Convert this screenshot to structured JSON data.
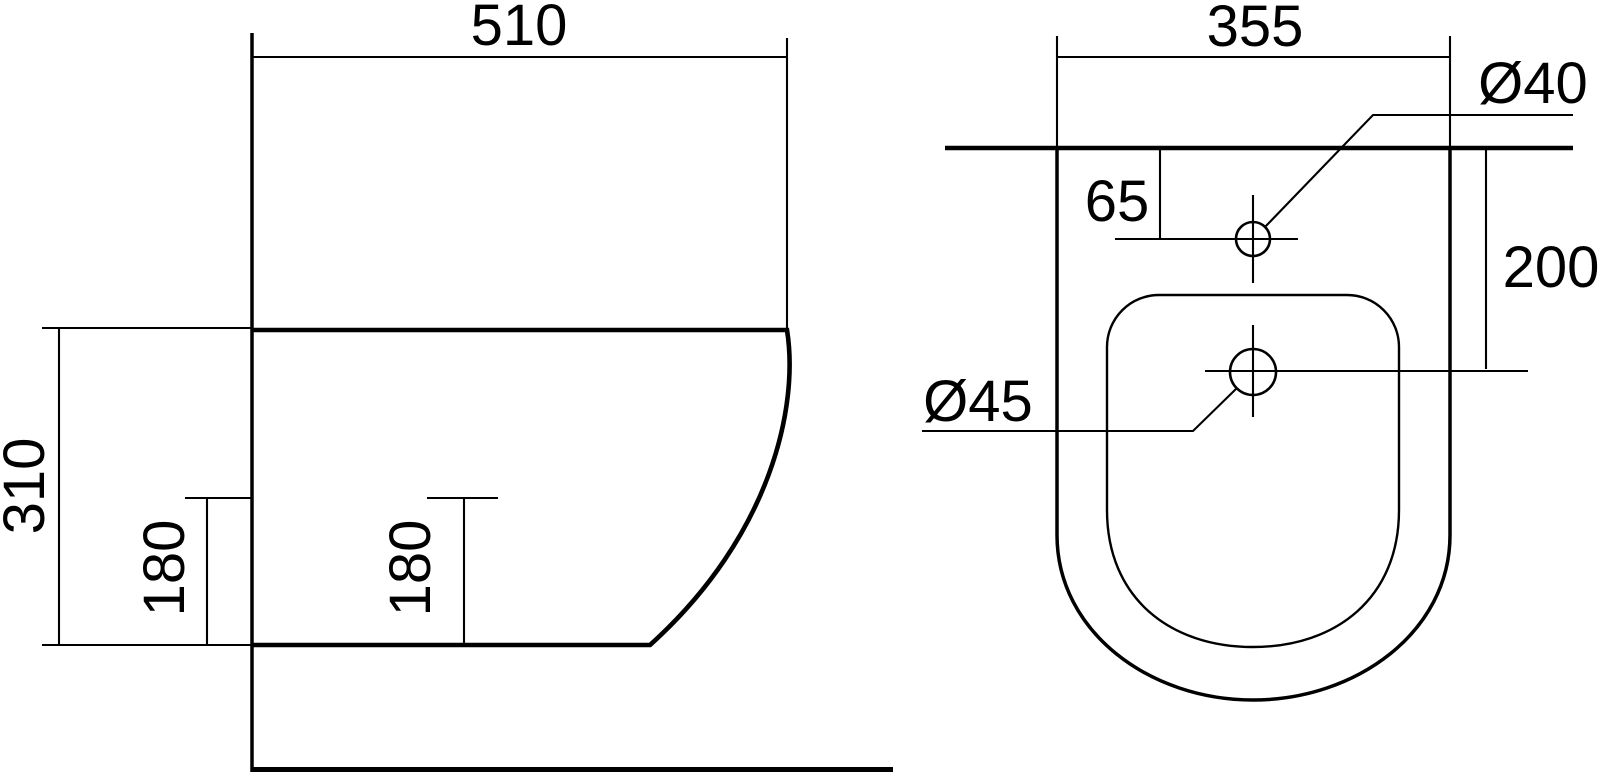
{
  "drawing": {
    "type": "technical-dimension-drawing",
    "subject": "wall-hung bidet",
    "background_color": "#ffffff",
    "line_color": "#000000",
    "views": {
      "side": {
        "label": "side-view",
        "dims": {
          "depth": "510",
          "height": "310",
          "fixing_height_left": "180",
          "fixing_height_right": "180"
        }
      },
      "plan": {
        "label": "plan-view",
        "dims": {
          "width": "355",
          "inlet_offset": "65",
          "inlet_diameter": "Ø40",
          "drain_offset": "200",
          "drain_diameter": "Ø45"
        }
      }
    }
  }
}
